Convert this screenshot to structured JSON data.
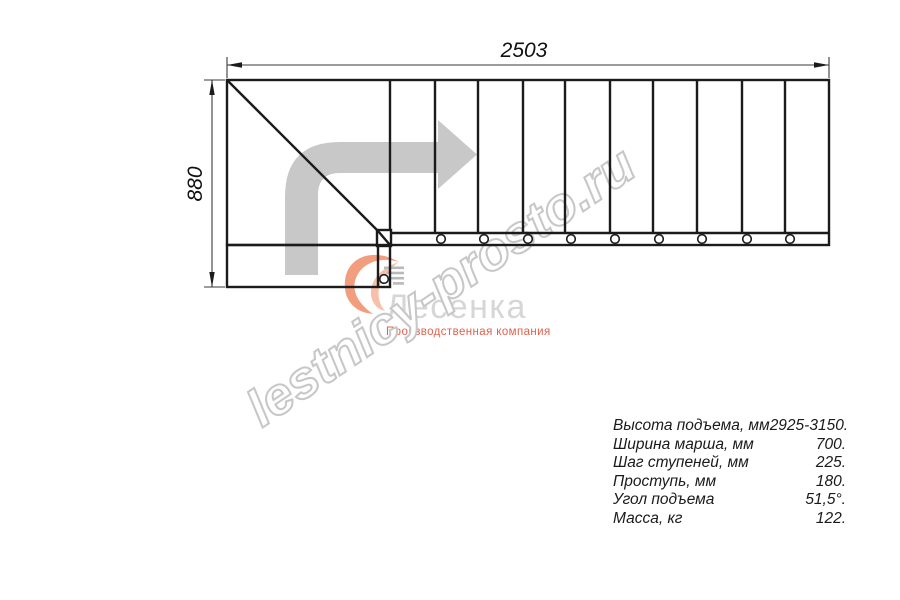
{
  "drawing": {
    "width_dimension": "2503",
    "height_dimension": "880"
  },
  "watermark": "lestnicy-prosto.ru",
  "logo": {
    "name": "Лесенка",
    "tagline": "Производственная компания"
  },
  "specs": {
    "rows": [
      {
        "label": "Высота подъема, мм",
        "value": "2925-3150."
      },
      {
        "label": "Ширина марша, мм",
        "value": "700."
      },
      {
        "label": "Шаг ступеней, мм",
        "value": "225."
      },
      {
        "label": "Проступь, мм",
        "value": "180."
      },
      {
        "label": "Угол подъема",
        "value": "51,5°."
      },
      {
        "label": "Масса, кг",
        "value": "122."
      }
    ]
  },
  "colors": {
    "line": "#1b1b1b",
    "dimension": "#3a3a3a",
    "arrow_gray": "#c8c8c8",
    "watermark_gray": "#c7c7c7",
    "logo_gray": "#d6d6d6",
    "logo_red": "#e0614d",
    "logo_swirl": "#f29d7e"
  }
}
